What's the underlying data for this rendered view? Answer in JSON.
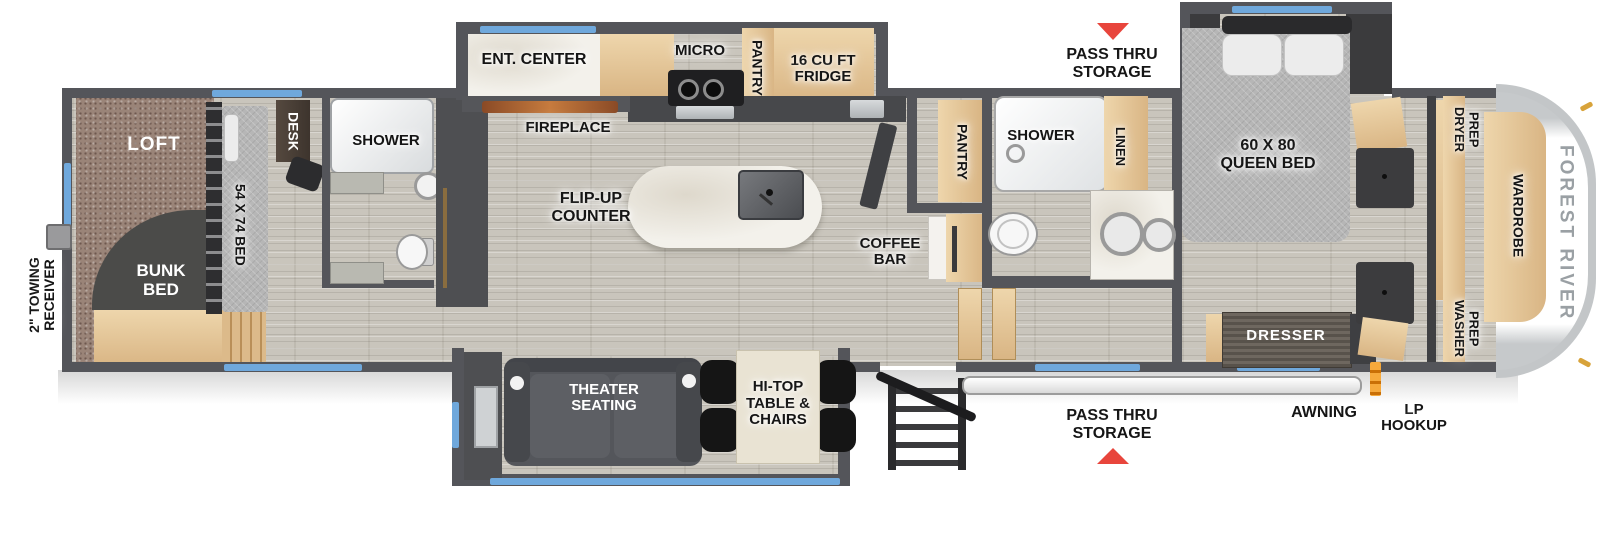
{
  "title": "Fifth wheel RV floor plan",
  "labels": {
    "towing": "2\" TOWING\nRECEIVER",
    "loft": "LOFT",
    "bunk_bed": "BUNK\nBED",
    "bunk_bed_size": "54 X 74 BED",
    "desk": "DESK",
    "bunk_shower": "SHOWER",
    "ent_center": "ENT. CENTER",
    "fireplace": "FIREPLACE",
    "micro": "MICRO",
    "kitchen_pantry": "PANTRY",
    "fridge": "16 CU FT\nFRIDGE",
    "flip_up_counter": "FLIP-UP\nCOUNTER",
    "coffee_bar": "COFFEE\nBAR",
    "theater_seating": "THEATER\nSEATING",
    "hi_top": "HI-TOP\nTABLE &\nCHAIRS",
    "bath_pantry": "PANTRY",
    "bath_shower": "SHOWER",
    "linen": "LINEN",
    "pass_thru_top": "PASS THRU\nSTORAGE",
    "pass_thru_bottom": "PASS THRU\nSTORAGE",
    "queen_bed": "60 X 80\nQUEEN BED",
    "dresser": "DRESSER",
    "dryer_prep": "DRYER\nPREP",
    "washer_prep": "WASHER\nPREP",
    "wardrobe": "WARDROBE",
    "brand": "FOREST RIVER",
    "awning": "AWNING",
    "lp_hookup": "LP\nHOOKUP"
  },
  "colors": {
    "wall_gray": "#54555a",
    "window_blue": "#6fa8dc",
    "arrow_red": "#e8453c",
    "lp_orange": "#f0932b",
    "carpet_brown": "#9a8478"
  }
}
